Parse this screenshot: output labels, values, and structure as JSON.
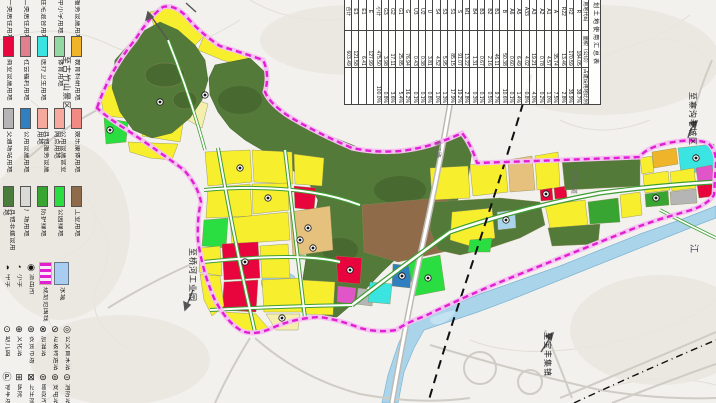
{
  "doc": {
    "type_note": "scanned land-use planning map, annotations rotated 90deg",
    "boundary_color": "#e020d0",
    "water_color": "#a9d4ea"
  },
  "legend": {
    "row0_labels": [
      "一类居住用地",
      "二类居住用地",
      "住宅混合用地",
      "中小学用地",
      "服务设施用地"
    ],
    "row1": [
      {
        "color": "#e8043c",
        "label": "商业设施用地"
      },
      {
        "color": "#e0808e",
        "label": "社会福利用地"
      },
      {
        "color": "#3ae4e0",
        "label": "医疗卫生用地"
      },
      {
        "color": "#93d7a2",
        "label": "体育用地"
      },
      {
        "color": "#f0b42a",
        "label": "教育科研用地"
      }
    ],
    "row2": [
      {
        "color": "#b5b5b5",
        "label": "交通场站用地"
      },
      {
        "color": "#2f7fc1",
        "label": "公用设施用地"
      },
      {
        "color": "#f6aa9e",
        "label": "其他服务设施用地"
      },
      {
        "color": "#f6aa9e",
        "label": "公用设施营业网点用地"
      },
      {
        "color": "#f08a82",
        "label": "娱乐康体用地"
      }
    ],
    "row3": [
      {
        "color": "#4a7d3c",
        "label": "其他非建设用地"
      },
      {
        "color": "#d9d9d6",
        "label": "广场用地"
      },
      {
        "color": "#38a431",
        "label": "防护绿地"
      },
      {
        "color": "#2ade41",
        "label": "公园绿地"
      },
      {
        "color": "#8f6b4a",
        "label": "工业用地"
      }
    ],
    "boundary_label": "规划范围线",
    "water_label": "水域",
    "fac_row_a": [
      {
        "g": "◑",
        "label": "中学"
      },
      {
        "g": "◔",
        "label": "小学"
      },
      {
        "g": "◉",
        "label": "派出所"
      }
    ],
    "fac_row_b": [
      {
        "g": "⊙",
        "label": "幼儿园"
      },
      {
        "g": "⊕",
        "label": "文化站"
      },
      {
        "g": "⊛",
        "label": "农贸市场"
      },
      {
        "g": "⊗",
        "label": "加油站"
      },
      {
        "g": "⊘",
        "label": "垃圾转运站"
      },
      {
        "g": "◎",
        "label": "公交首末站"
      }
    ],
    "fac_row_c": [
      {
        "g": "Ⓟ",
        "label": "停车场"
      },
      {
        "g": "⊞",
        "label": "医院"
      },
      {
        "g": "⊠",
        "label": "卫生院"
      },
      {
        "g": "⊜",
        "label": "邮政所"
      },
      {
        "g": "⊚",
        "label": "变电站"
      },
      {
        "g": "⊝",
        "label": "消防站"
      }
    ]
  },
  "table": {
    "title": "规划土地使用汇总表",
    "headers": [
      "用地类别",
      "用地代码",
      "面积（公顷）",
      "占建设用地比例（%）"
    ],
    "rows": [
      [
        "居住用地",
        "R",
        "184.05",
        "38.7%"
      ],
      [
        "",
        "R2",
        "170.59",
        "35.9%"
      ],
      [
        "",
        "R22",
        "13.46",
        "2.8%"
      ],
      [
        "公共管理与公共服务设施用地",
        "A",
        "35.74",
        "7.5%"
      ],
      [
        "",
        "A1",
        "4.57",
        "1.0%"
      ],
      [
        "",
        "A2",
        "0.78",
        "0.2%"
      ],
      [
        "",
        "A3",
        "19.21",
        "4.0%"
      ],
      [
        "",
        "A33",
        "4.02",
        "0.8%"
      ],
      [
        "",
        "A5",
        "6.49",
        "1.4%"
      ],
      [
        "",
        "A6",
        "0.60",
        "0.1%"
      ],
      [
        "商业服务业设施用地",
        "B",
        "50.38",
        "10.6%"
      ],
      [
        "",
        "B1",
        "46.11",
        "9.7%"
      ],
      [
        "",
        "B2",
        "2.16",
        "0.5%"
      ],
      [
        "",
        "B3",
        "0.67",
        "0.1%"
      ],
      [
        "",
        "B4",
        "1.31",
        "0.3%"
      ],
      [
        "工业用地",
        "M1",
        "13.22",
        "2.8%"
      ],
      [
        "道路与交通设施用地",
        "S",
        "91.07",
        "19.2%"
      ],
      [
        "",
        "S1",
        "85.15",
        "17.9%"
      ],
      [
        "",
        "S3",
        "5.95",
        "1.3%"
      ],
      [
        "",
        "S4",
        "4.52",
        "1.0%"
      ],
      [
        "公用设施用地",
        "U",
        "3.81",
        "0.8%"
      ],
      [
        "",
        "U2",
        "0.38",
        "0.1%"
      ],
      [
        "",
        "U3",
        "0.43",
        "0.1%"
      ],
      [
        "绿地与广场用地",
        "G",
        "76.94",
        "16.2%"
      ],
      [
        "",
        "G1",
        "25.85",
        "5.4%"
      ],
      [
        "",
        "G2",
        "17.11",
        "3.6%"
      ],
      [
        "",
        "G3",
        "3.98",
        "0.8%"
      ],
      [
        "建设用地",
        "小计",
        "475.50",
        "100.0%"
      ],
      [
        "非建设用地",
        "E",
        "127.99",
        ""
      ],
      [
        "",
        "E1",
        "6.41",
        ""
      ],
      [
        "",
        "E3",
        "121.58",
        ""
      ],
      [
        "总用地",
        "合计",
        "603.49",
        ""
      ]
    ]
  },
  "map": {
    "labels": [
      {
        "text": "至古竹山景区",
        "x": 62,
        "y": 56,
        "cls": ""
      },
      {
        "text": "至桥河工业园",
        "x": 188,
        "y": 248,
        "cls": ""
      },
      {
        "text": "至寨沟老城区",
        "x": 688,
        "y": 92,
        "cls": ""
      },
      {
        "text": "至宝丰集镇",
        "x": 543,
        "y": 332,
        "cls": ""
      },
      {
        "text": "迎宾大道",
        "x": 570,
        "y": 170,
        "cls": "road"
      },
      {
        "text": "滨江路",
        "x": 434,
        "y": 140,
        "cls": "road"
      },
      {
        "text": "江",
        "x": 689,
        "y": 244,
        "cls": "big"
      }
    ]
  }
}
